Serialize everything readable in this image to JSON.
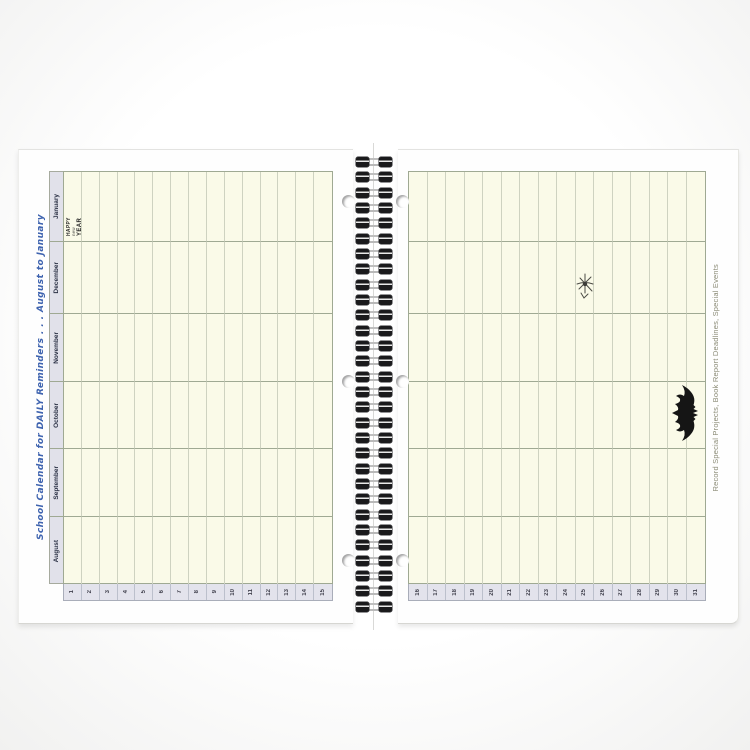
{
  "title": "School Calendar for DAILY Reminders . . . August to January",
  "calendar": {
    "months": [
      "January",
      "December",
      "November",
      "October",
      "September",
      "August"
    ],
    "left_days": [
      "1",
      "2",
      "3",
      "4",
      "5",
      "6",
      "7",
      "8",
      "9",
      "10",
      "11",
      "12",
      "13",
      "14",
      "15"
    ],
    "right_days": [
      "16",
      "17",
      "18",
      "19",
      "20",
      "21",
      "22",
      "23",
      "24",
      "25",
      "26",
      "27",
      "28",
      "29",
      "30",
      "31"
    ]
  },
  "right_page": {
    "side_note": "Record Special Projects, Book Report Deadlines, Special Events"
  },
  "cliparts": {
    "new_year_banner_lines": [
      "HAPPY",
      "new",
      "YEAR"
    ],
    "christmas_icon": "holiday-line-art",
    "halloween_icon": "bat-silhouette"
  },
  "colors": {
    "cell_cream": "#fafae8",
    "header_lavender": "#e1e1ea",
    "grid_line": "#ced2c0",
    "band_line": "#9fa993",
    "title_blue": "#3e63af",
    "side_note_olive": "#8b8b76",
    "coil_black": "#1a1a1c"
  }
}
